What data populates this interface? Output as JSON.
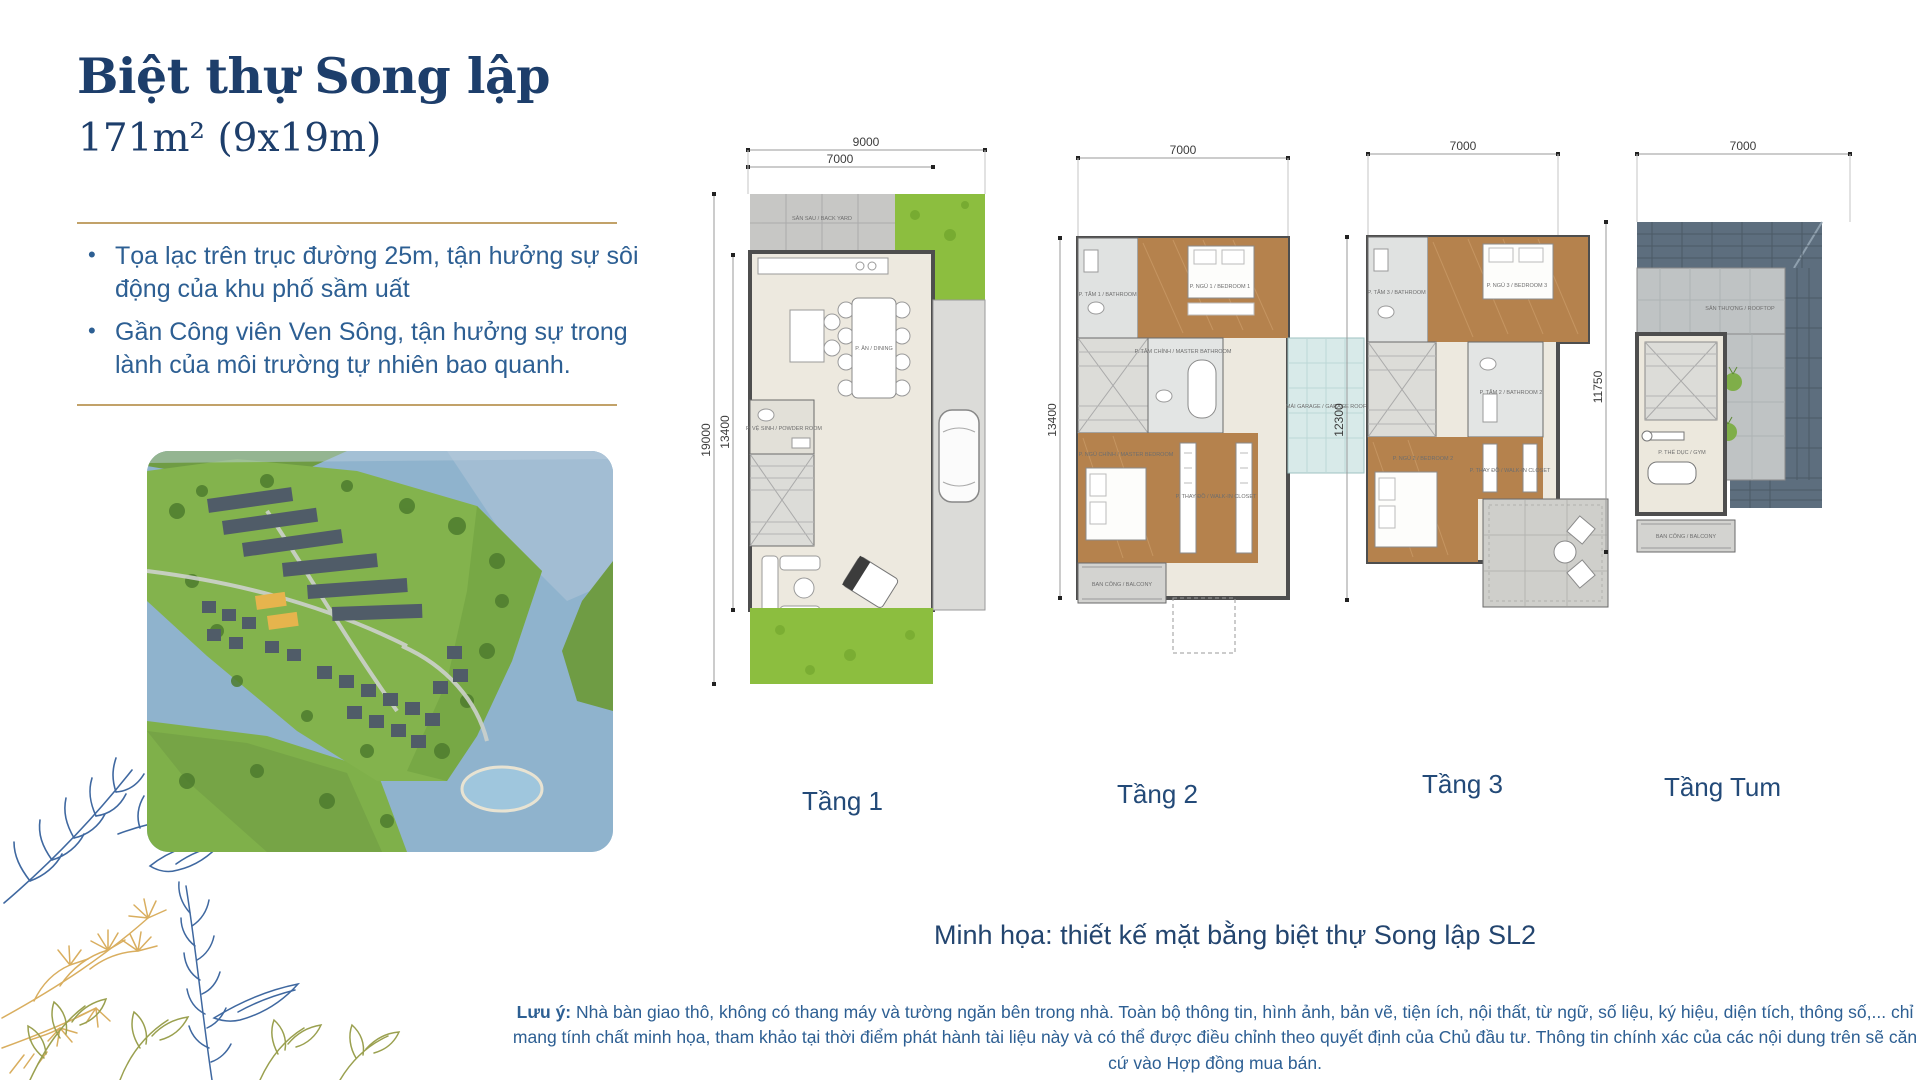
{
  "header": {
    "title": "Biệt thự Song lập",
    "subtitle": "171m² (9x19m)"
  },
  "intro": {
    "bullets": [
      "Tọa lạc trên trục đường 25m, tận hưởng sự sôi động của khu phố sầm uất",
      "Gần Công viên Ven Sông, tận hưởng sự trong lành của môi trường tự nhiên bao quanh."
    ]
  },
  "floors": [
    {
      "label": "Tầng 1",
      "dims": {
        "lot_width": "9000",
        "house_width": "7000",
        "lot_depth": "19000",
        "house_depth": "13400"
      },
      "rooms": {
        "backyard": "SÂN SAU / BACK YARD",
        "dining": "P. ĂN / DINING",
        "powder": "P. VỆ SINH / POWDER ROOM"
      }
    },
    {
      "label": "Tầng 2",
      "dims": {
        "width": "7000",
        "depth": "13400"
      },
      "rooms": {
        "bath1": "P. TẮM 1 / BATHROOM 1",
        "bed1": "P. NGỦ 1 / BEDROOM 1",
        "masterbath": "P. TẮM CHÍNH / MASTER BATHROOM",
        "garageroof": "MÁI GARAGE / GARAGE ROOF",
        "masterbed": "P. NGỦ CHÍNH / MASTER BEDROOM",
        "closet": "P. THAY ĐỒ / WALK-IN CLOSET",
        "balcony": "BAN CÔNG / BALCONY"
      }
    },
    {
      "label": "Tầng 3",
      "dims": {
        "width": "7000",
        "depth": "12300"
      },
      "rooms": {
        "bath3": "P. TẮM 3 / BATHROOM 3",
        "bed3": "P. NGỦ 3 / BEDROOM 3",
        "bath2": "P. TẮM 2 / BATHROOM 2",
        "bed2": "P. NGỦ 2 / BEDROOM 2",
        "closet": "P. THAY ĐỒ / WALK-IN CLOSET"
      }
    },
    {
      "label": "Tầng Tum",
      "dims": {
        "width": "7000",
        "depth": "11750"
      },
      "rooms": {
        "rooftop": "SÂN THƯỢNG / ROOFTOP",
        "gym": "P. THỂ DỤC / GYM",
        "balcony": "BAN CÔNG / BALCONY"
      }
    }
  ],
  "caption": "Minh họa: thiết kế mặt bằng biệt thự Song lập SL2",
  "disclaimer": {
    "label": "Lưu ý:",
    "text": " Nhà bàn giao thô, không có thang máy và tường ngăn bên trong nhà. Toàn bộ thông tin, hình ảnh, bản vẽ, tiện ích, nội thất, từ ngữ, số liệu, ký hiệu, diện tích, thông số,... chỉ mang tính chất minh họa, tham khảo tại thời điểm phát hành tài liệu này và có thể được điều chỉnh theo quyết định của Chủ đầu tư. Thông tin chính xác của các nội dung trên sẽ căn cứ vào Hợp đồng mua bán."
  },
  "colors": {
    "navy": "#1d3e6b",
    "body_blue": "#2d5f93",
    "gold_rule": "#c2a269",
    "floor_beige": "#ede9df",
    "wood": "#b5824d",
    "yard_gray": "#c7c7c5",
    "grass": "#8cbe3f",
    "canopy_blue": "#d8eae9",
    "roof_slate": "#5d6e7e"
  }
}
